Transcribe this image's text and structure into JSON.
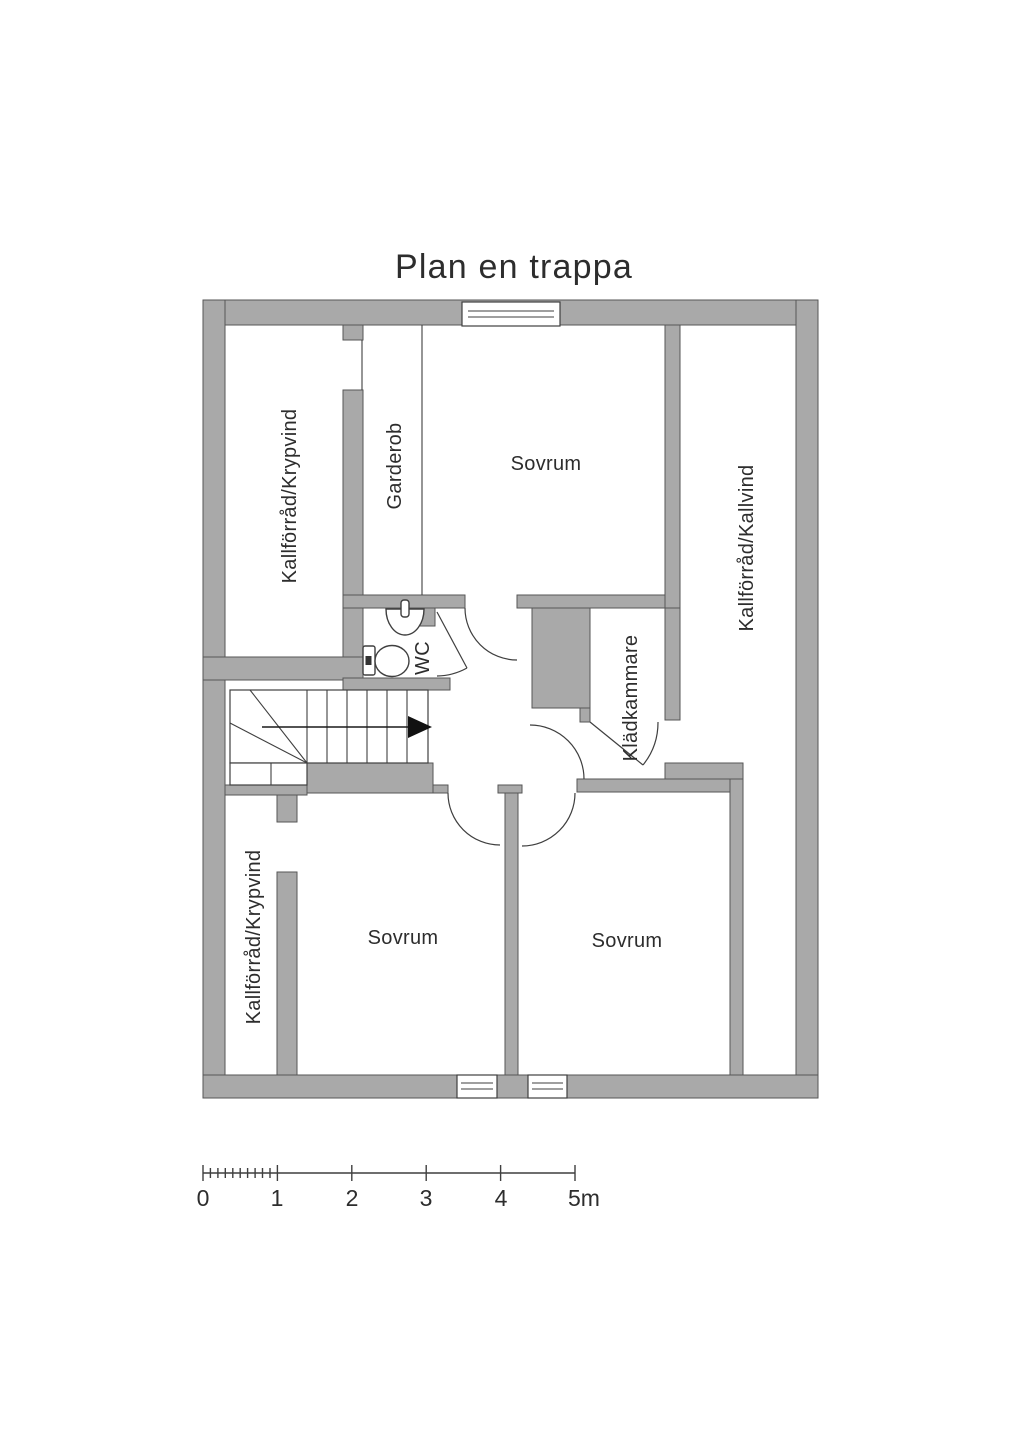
{
  "title": "Plan en trappa",
  "colors": {
    "wall_fill": "#a9a9a9",
    "outline": "#3f3f3f",
    "text": "#2d2d2d",
    "background": "#ffffff"
  },
  "rooms": [
    {
      "id": "kallforrad-krypvind-top",
      "label": "Kallförråd/Krypvind"
    },
    {
      "id": "garderob",
      "label": "Garderob"
    },
    {
      "id": "sovrum-top",
      "label": "Sovrum"
    },
    {
      "id": "kallforrad-kallvind",
      "label": "Kallförråd/Kallvind"
    },
    {
      "id": "wc",
      "label": "WC"
    },
    {
      "id": "kladkammare",
      "label": "Klädkammare"
    },
    {
      "id": "kallforrad-krypvind-bottom",
      "label": "Kallförråd/Krypvind"
    },
    {
      "id": "sovrum-bottom-left",
      "label": "Sovrum"
    },
    {
      "id": "sovrum-bottom-right",
      "label": "Sovrum"
    }
  ],
  "scale_bar": {
    "tick_labels": [
      "0",
      "1",
      "2",
      "3",
      "4",
      "5m"
    ],
    "unit": "m",
    "max_value": 5
  }
}
